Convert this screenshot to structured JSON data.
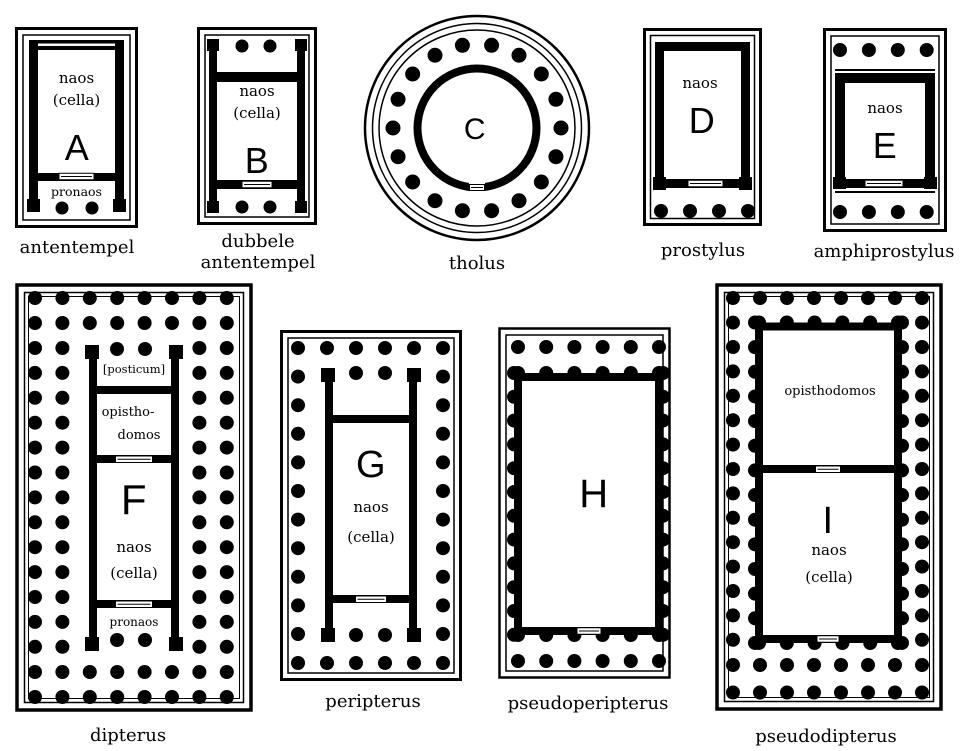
{
  "ink": "#000000",
  "background": "#ffffff",
  "plans": {
    "antentempel": {
      "caption": "antentempel",
      "letter": "A",
      "naos": "naos",
      "cella": "(cella)",
      "pronaos": "pronaos"
    },
    "dubbele_antentempel": {
      "caption_line1": "dubbele",
      "caption_line2": "antentempel",
      "letter": "B",
      "naos": "naos",
      "cella": "(cella)"
    },
    "tholus": {
      "caption": "tholus",
      "letter": "C"
    },
    "prostylus": {
      "caption": "prostylus",
      "letter": "D",
      "naos": "naos"
    },
    "amphiprostylus": {
      "caption": "amphiprostylus",
      "letter": "E",
      "naos": "naos"
    },
    "dipterus": {
      "caption": "dipterus",
      "letter": "F",
      "posticum": "[posticum]",
      "opisthodomos_line1": "opistho-",
      "opisthodomos_line2": "domos",
      "naos": "naos",
      "cella": "(cella)",
      "pronaos": "pronaos"
    },
    "peripterus": {
      "caption": "peripterus",
      "letter": "G",
      "naos": "naos",
      "cella": "(cella)"
    },
    "pseudoperipterus": {
      "caption": "pseudoperipterus",
      "letter": "H"
    },
    "pseudodipterus": {
      "caption": "pseudodipterus",
      "letter": "I",
      "opisthodomos": "opisthodomos",
      "naos": "naos",
      "cella": "(cella)"
    }
  }
}
